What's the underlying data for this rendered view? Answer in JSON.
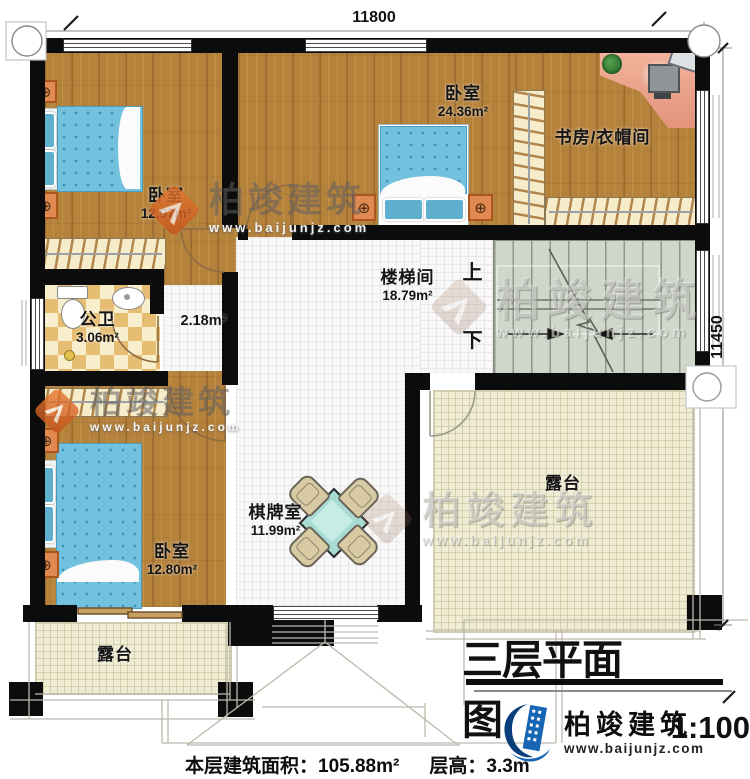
{
  "dimensions": {
    "top": "11800",
    "right": "11450"
  },
  "rooms": {
    "bedroom_tl": {
      "label": "卧室",
      "area": "12.97m²"
    },
    "bedroom_top": {
      "label": "卧室",
      "area": "24.36m²"
    },
    "study_cloak": {
      "label": "书房/衣帽间"
    },
    "bathroom": {
      "label": "公卫",
      "area": "3.06m²"
    },
    "hallway": {
      "area": "2.18m²"
    },
    "stairwell": {
      "label": "楼梯间",
      "area": "18.79m²",
      "up_label": "上",
      "down_label": "下"
    },
    "bedroom_bl": {
      "label": "卧室",
      "area": "12.80m²"
    },
    "game_room": {
      "label": "棋牌室",
      "area": "11.99m²"
    },
    "terrace_right": {
      "label": "露台"
    },
    "terrace_bottom": {
      "label": "露台"
    }
  },
  "title_block": {
    "title": "三层平面图",
    "scale": "1:100"
  },
  "footer": {
    "area_label": "本层建筑面积：",
    "area_value": "105.88m²",
    "floor_height_label": "层高：",
    "floor_height_value": "3.3m"
  },
  "brand": {
    "name": "柏竣建筑",
    "url": "www.baijunjz.com"
  },
  "watermark": {
    "name": "柏竣建筑",
    "url": "www.baijunjz.com"
  },
  "colors": {
    "wall": "#0c0c0c",
    "wood_floor": "#b5823c",
    "bed_blue": "#72c1de",
    "table_teal": "#a7dcd5",
    "brand_blue": "#1766b3",
    "watermark_orange": "#e0722c"
  }
}
